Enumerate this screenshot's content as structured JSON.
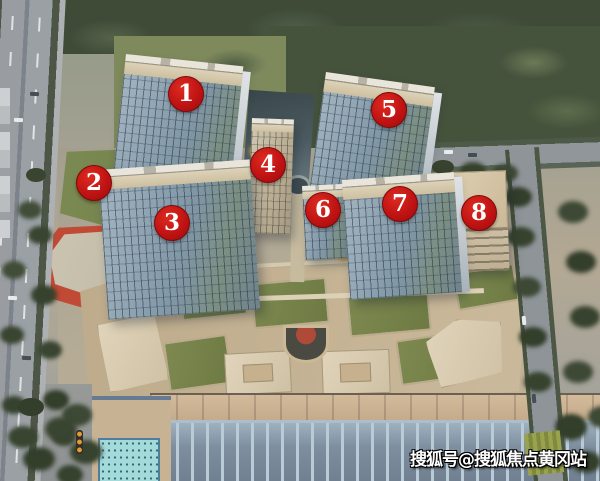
{
  "scene": {
    "description": "Aerial rendering of a mixed-use development with eight numbered buildings, surrounding roads, retail podium with green roofs, and a large blue-roofed hall in front",
    "markers": [
      {
        "label": "1"
      },
      {
        "label": "2"
      },
      {
        "label": "3"
      },
      {
        "label": "4"
      },
      {
        "label": "5"
      },
      {
        "label": "6"
      },
      {
        "label": "7"
      },
      {
        "label": "8"
      }
    ],
    "marker_color": "#c01313",
    "watermark": {
      "text": "搜狐号@搜狐焦点黄冈站",
      "color": "#ffffff"
    },
    "palette": {
      "tree_dark": "#3d4935",
      "grass": "#7e8a5c",
      "field_olive": "#76854e",
      "tower_glass": "#8499a9",
      "tower_crown": "#d3c7ab",
      "podium_tan": "#c2b193",
      "roof_olive": "#75814a",
      "red_building": "#c04a35",
      "road_gray": "#93989c",
      "warehouse_roof": "#8292a3",
      "cyan_glass": "#a5dadb"
    }
  }
}
